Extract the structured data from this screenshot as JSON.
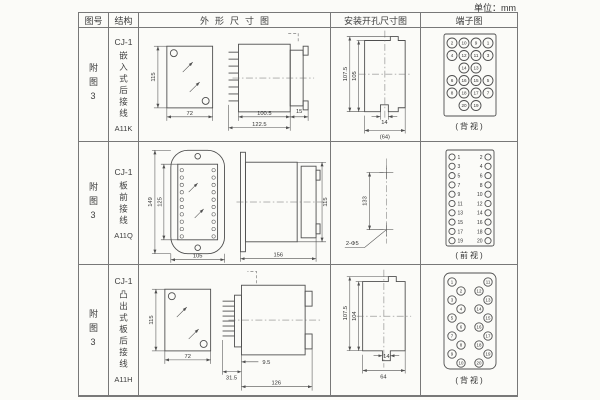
{
  "unit_label": "单位：mm",
  "header": {
    "fig": "图号",
    "struct": "结构",
    "outline": "外形尺寸图",
    "install": "安装开孔尺寸图",
    "terminal": "端子图"
  },
  "rows": [
    {
      "fig": "附图3",
      "model": "CJ-1",
      "desc": "嵌入式后接线",
      "code": "A11K",
      "outline": {
        "h": "115",
        "w": "72",
        "body": "100.5",
        "total": "122.5",
        "rear": "15"
      },
      "install": {
        "outer": "107.5",
        "inner": "105",
        "slot": "14",
        "width": "(64)"
      },
      "view": "(背视)"
    },
    {
      "fig": "附图3",
      "model": "CJ-1",
      "desc": "板前接线",
      "code": "A11Q",
      "outline": {
        "outer_h": "149",
        "inner_h": "125",
        "w": "105",
        "len": "156",
        "h": "115"
      },
      "install": {
        "v": "133",
        "holes": "2-Φ5"
      },
      "view": "(前视)"
    },
    {
      "fig": "附图3",
      "model": "CJ-1",
      "desc": "凸出式板后接线",
      "code": "A11H",
      "outline": {
        "h": "115",
        "w": "72",
        "pins": "31.5",
        "offset": "9.5",
        "len": "126"
      },
      "install": {
        "outer": "107.5",
        "inner": "104",
        "slot": "14",
        "width": "64"
      },
      "view": "(背视)"
    }
  ],
  "terminals": {
    "back_embedded": {
      "rows": [
        [
          "2",
          "10",
          "9",
          "1"
        ],
        [
          "4",
          "12",
          "11",
          "3"
        ],
        [
          "",
          "14",
          "13",
          ""
        ],
        [
          "6",
          "16",
          "15",
          "5"
        ],
        [
          "8",
          "18",
          "17",
          "7"
        ],
        [
          "",
          "20",
          "19",
          ""
        ]
      ]
    },
    "front_board": {
      "left": [
        "1",
        "3",
        "5",
        "7",
        "9",
        "11",
        "13",
        "15",
        "17",
        "19"
      ],
      "right": [
        "2",
        "4",
        "6",
        "8",
        "10",
        "12",
        "14",
        "16",
        "18",
        "20"
      ]
    },
    "back_convex": {
      "left_outer": [
        "1",
        "3",
        "5",
        "7",
        "9"
      ],
      "left_inner": [
        "2",
        "4",
        "6",
        "8",
        "10"
      ],
      "right_inner": [
        "12",
        "14",
        "16",
        "18",
        "20"
      ],
      "right_outer": [
        "11",
        "13",
        "15",
        "17",
        "19"
      ]
    }
  }
}
